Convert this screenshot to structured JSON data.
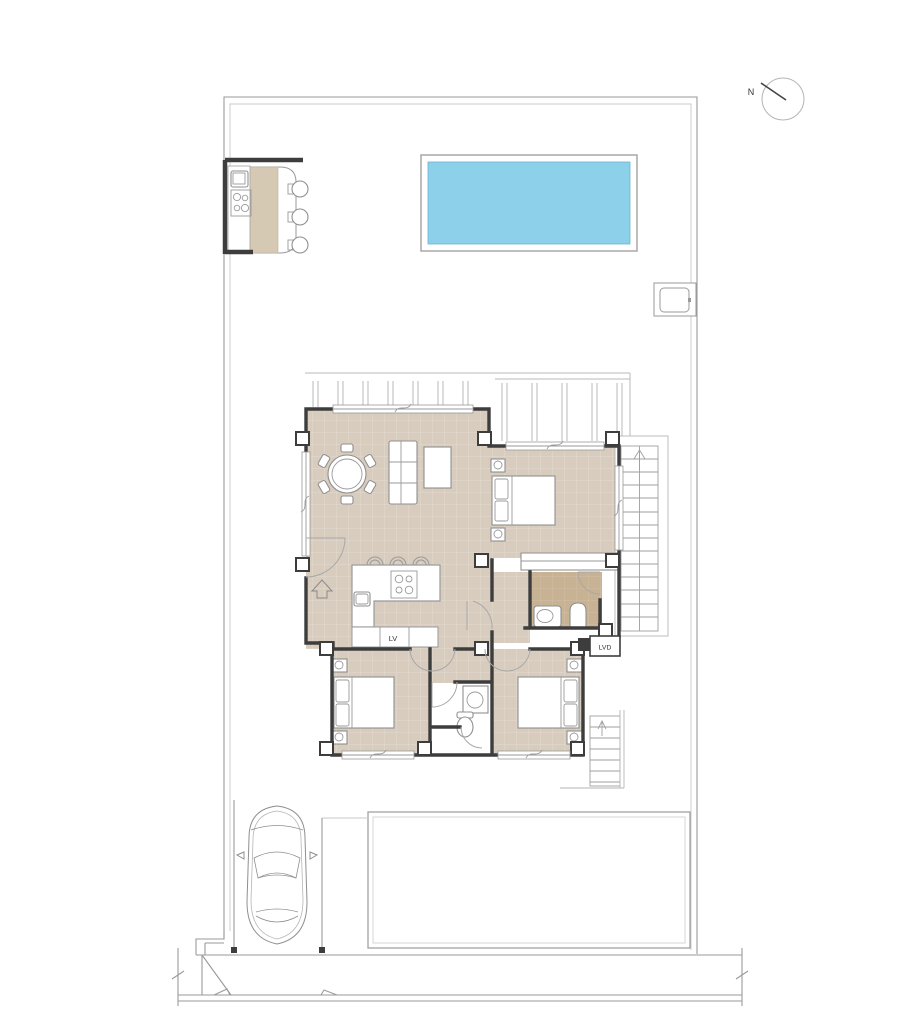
{
  "compass": {
    "label": "N"
  },
  "appliance_labels": {
    "dishwasher": "LV",
    "washer": "LVD"
  },
  "colors": {
    "pool_water": "#8DD0EA",
    "pool_water_border": "#6FB4CF",
    "floor_tan": "#D8CCBE",
    "floor_grid": "#E7DFD4",
    "floor_dark": "#C8B294",
    "floor_dark_grid": "#D5C3A8",
    "counter_tan": "#D6C9B3",
    "wall": "#3D3D3D"
  }
}
